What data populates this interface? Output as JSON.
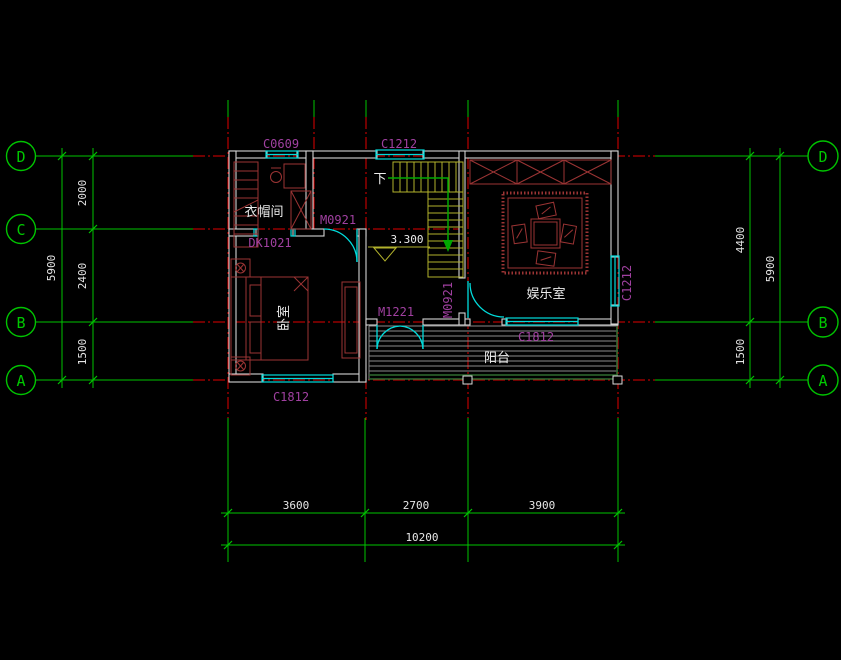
{
  "drawing": {
    "type": "floor-plan",
    "colors": {
      "background": "#000000",
      "axis_green": "#00C400",
      "grid_red": "#E00000",
      "wall": "#D4D4D4",
      "fixture_cyan": "#00DCDC",
      "label_magenta": "#A040A0",
      "furniture_red": "#9B3434",
      "stair_yellow": "#B2B22C",
      "balcony_green": "#2F6B2F",
      "text_white": "#E6E6E6"
    }
  },
  "axes": {
    "left": [
      "D",
      "C",
      "B",
      "A"
    ],
    "right": [
      "D",
      "B",
      "A"
    ]
  },
  "dimensions": {
    "left": {
      "segments": [
        "2000",
        "2400",
        "1500"
      ],
      "total": "5900"
    },
    "right": {
      "segments": [
        "4400",
        "1500"
      ],
      "total": "5900"
    },
    "bottom": {
      "segments": [
        "3600",
        "2700",
        "3900"
      ],
      "total": "10200"
    }
  },
  "rooms": {
    "cloakroom": "衣帽间",
    "bedroom": "卧室",
    "entertainment": "娱乐室",
    "balcony": "阳台"
  },
  "openings": {
    "c0609": "C0609",
    "c1212_top": "C1212",
    "c1212_right": "C1212",
    "c1812_bedroom": "C1812",
    "c1812_entertainment": "C1812",
    "dk1021": "DK1021",
    "m0921_bedroom": "M0921",
    "m0921_entertainment": "M0921",
    "m1221": "M1221"
  },
  "stairs": {
    "down": "下",
    "elevation": "3.300"
  }
}
